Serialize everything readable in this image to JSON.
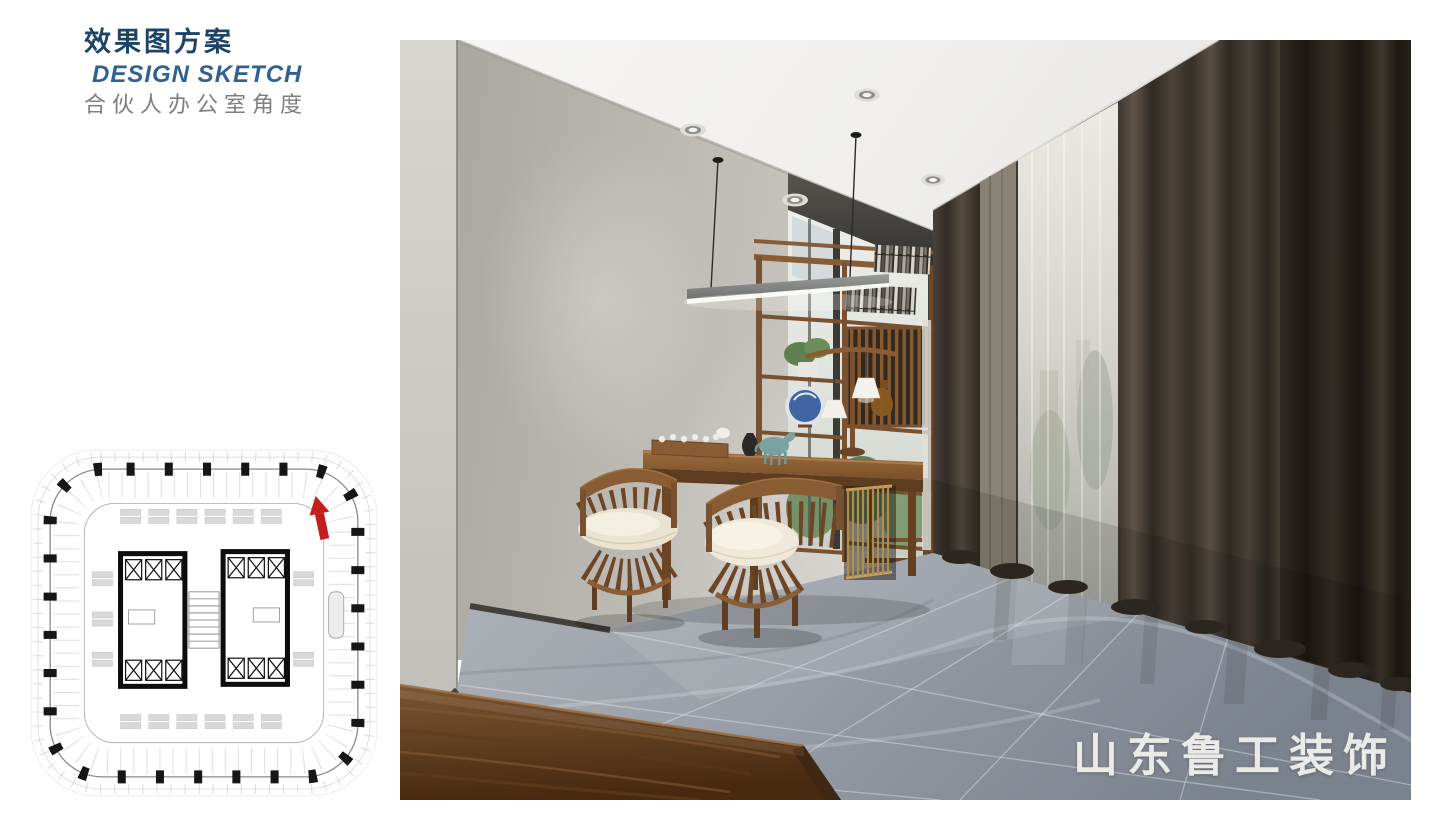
{
  "header": {
    "title_zh": "效果图方案",
    "title_en": "DESIGN SKETCH",
    "subtitle_zh": "合伙人办公室角度"
  },
  "rendering": {
    "watermark": "山东鲁工装饰"
  },
  "floor_plan": {
    "view_marker": "red-arrow-up"
  },
  "colors": {
    "title_navy": "#1e4368",
    "title_blue": "#2f6191",
    "subtitle_gray": "#7f7f7f",
    "arrow_red": "#c41f1f",
    "watermark_white": "#f2f1ee",
    "wood_accent": "#8a5c33",
    "curtain_dark": "#3a332b",
    "floor_gray": "#8b929c"
  }
}
